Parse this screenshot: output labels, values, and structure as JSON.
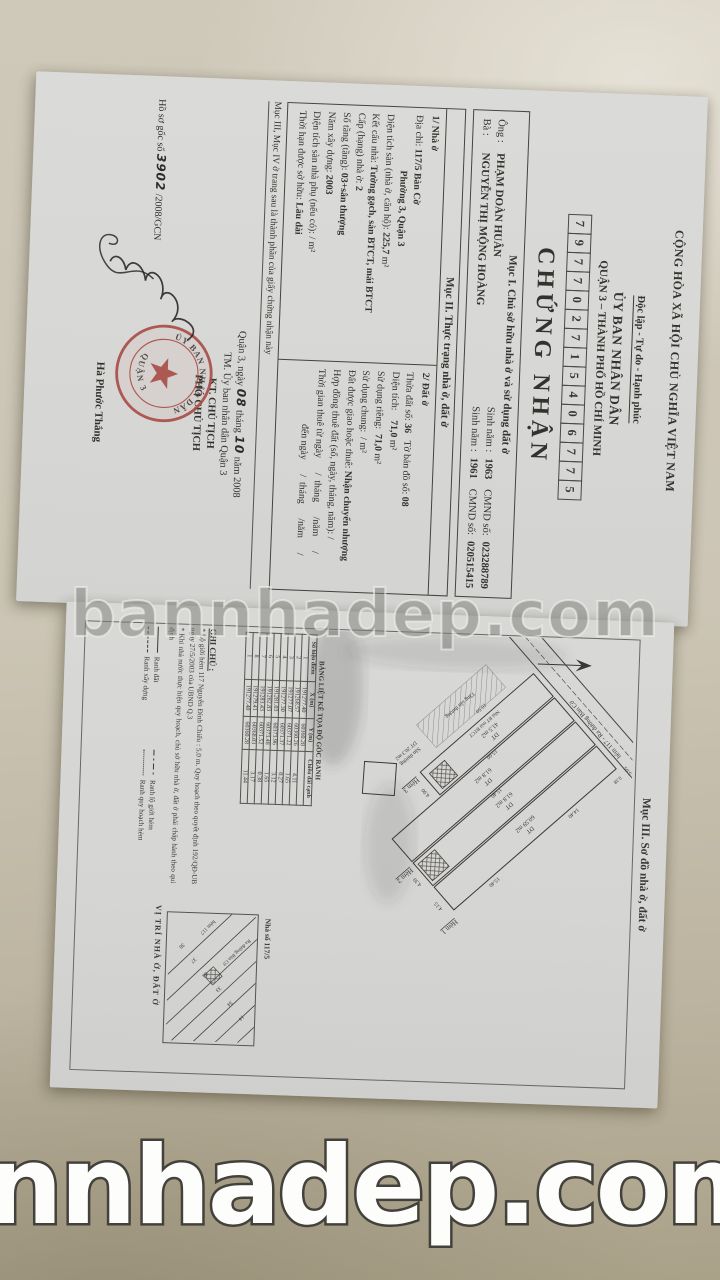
{
  "watermarks": {
    "center": "bannhadep.com",
    "bottom": "nnhadep.com"
  },
  "certificate": {
    "national_motto_1": "CỘNG HÒA XÃ HỘI CHỦ NGHĨA VIỆT NAM",
    "national_motto_2": "Độc lập - Tự do - Hạnh phúc",
    "issuer": "ỦY BAN NHÂN DÂN",
    "issuer_locality": "QUẬN 3 – THÀNH PHỐ HỒ CHÍ MINH",
    "serial_digits": [
      "7",
      "9",
      "7",
      "7",
      "0",
      "2",
      "7",
      "1",
      "5",
      "4",
      "0",
      "6",
      "7",
      "7",
      "5"
    ],
    "title": "CHỨNG NHẬN",
    "section1": {
      "heading": "Mục I. Chủ sở hữu nhà ở và sử dụng đất ở",
      "owner1_label": "Ông :",
      "owner1_name": "PHẠM DOÀN HUÂN",
      "owner1_birth_label": "Sinh năm :",
      "owner1_birth": "1963",
      "owner1_id_label": "CMND số:",
      "owner1_id": "023288789",
      "owner2_label": "Bà :",
      "owner2_name": "NGUYỄN THỊ MỘNG HOÀNG",
      "owner2_birth_label": "Sinh năm :",
      "owner2_birth": "1961",
      "owner2_id_label": "CMND số:",
      "owner2_id": "020515415"
    },
    "section2": {
      "heading": "Mục II. Thực trạng nhà ở, đất ở",
      "house": {
        "heading": "1/ Nhà ở",
        "addr_label": "Địa chỉ:",
        "addr1": "117/5 Bàn Cờ",
        "addr2": "Phường 3, Quận 3",
        "floor_label": "Diện tích sàn (nhà ở, căn hộ):",
        "floor_value": "225,7",
        "floor_unit": "m²",
        "structure_label": "Kết cấu nhà:",
        "structure": "Tường gạch, sàn BTCT, mái BTCT",
        "grade_label": "Cấp (hạng) nhà ở:",
        "grade": "2",
        "storeys_label": "Số tầng (tầng):",
        "storeys": "03+sân thượng",
        "year_label": "Năm xây dựng:",
        "year": "2003",
        "aux_label": "Diện tích sàn nhà phụ (nếu có):",
        "aux_value": "/",
        "aux_unit": "m²",
        "tenure_label": "Thời hạn được sở hữu:",
        "tenure": "Lâu dài"
      },
      "land": {
        "heading": "2/ Đất ở",
        "plot_label": "Thửa đất số:",
        "plot": "36",
        "map_label": "Tờ bản đồ số:",
        "map": "08",
        "area_label": "Diện tích:",
        "area": "71,0",
        "area_unit": "m²",
        "private_label": "Sử dụng riêng:",
        "private_value": "71,0",
        "private_unit": "m²",
        "common_label": "Sử dụng chung:",
        "common_value": "/",
        "common_unit": "m²",
        "grant_label": "Đất được giao hoặc thuê:",
        "grant": "Nhận chuyển nhượng",
        "contract_label": "Hợp đồng thuê đất (số, ngày, tháng, năm):",
        "contract_value": "/",
        "lease_from_line": "Thời gian thuê từ ngày      /  tháng      /năm      /",
        "lease_to_line": "đến ngày      /  tháng      /năm      /"
      }
    },
    "note": "Mục III, Mục IV ở trang sau là thành phần của giấy chứng nhận này",
    "sign": {
      "date_prefix": "Quận 3, ngày",
      "day": "08",
      "month_label": "tháng",
      "month": "10",
      "year_label": "năm",
      "year": "2008",
      "authority": "TM. Ủy ban nhân dân Quận 3",
      "title_kt": "KT. CHỦ TỊCH",
      "title_pho": "PHÓ CHỦ TỊCH",
      "signer": "Hà Phước Thắng",
      "stamp_top": "ỦY BAN NHÂN DÂN",
      "stamp_bottom": "QUẬN 3"
    },
    "file_label": "Hồ sơ gốc số",
    "file_number": "3902",
    "file_suffix": "/2008/GCN"
  },
  "plan": {
    "heading": "Mục III. Sơ đồ nhà ở, đất ở",
    "street_label": "hẻm 117 - Ra đường Bàn Cờ",
    "dt_label": "DT",
    "lots": [
      "60.59 m2",
      "61.8 m2",
      "61.8 m2",
      "41.5 m2"
    ],
    "lot4_note": "Nhà BT mái BTCT",
    "roof_label": "Sân thượng",
    "roof_area": "DT 20.3 m2",
    "terrace_label": "Tầng sân thượng",
    "alley1": "Hẻm 1",
    "alley2": "Hẻm 2",
    "alley3": "Hẻm 3",
    "house_no": "Nhà số 117/5",
    "position_caption": "VỊ TRÍ NHÀ Ở, ĐẤT Ở",
    "dims": {
      "d1": "14.40",
      "d2": "15.40",
      "d3": "15.40",
      "d4": "15.60",
      "d5": "10.50",
      "d6": "4.15",
      "d7": "4.39",
      "d8": "4.90",
      "d9": "5.05",
      "d10": "0.38"
    },
    "coord_table": {
      "title": "BẢNG LIỆT KÊ TỌA ĐỘ GÓC RANH",
      "columns": [
        "Số hiệu điểm",
        "X (m)",
        "Y (m)",
        "Chiều dài cạnh"
      ],
      "rows": [
        [
          "1",
          "191277.40",
          "60360.28",
          ""
        ],
        [
          "2",
          "191268.57",
          "60360.26",
          "4.11"
        ],
        [
          "3",
          "191277.07",
          "60371.22",
          "1.65"
        ],
        [
          "4",
          "191277.30",
          "60371.37",
          "0.27"
        ],
        [
          "5",
          "191281.03",
          "60373.96",
          "3.12"
        ],
        [
          "6",
          "191282.83",
          "60373.48",
          "1.65"
        ],
        [
          "7",
          "191283.43",
          "60371.52",
          "0.38"
        ],
        [
          "8",
          "191279.41",
          "60368.03",
          "3.17"
        ],
        [
          "1",
          "191277.40",
          "60360.28",
          "11.44"
        ]
      ]
    },
    "notes": {
      "heading": "GHI CHÚ :",
      "line1": "* Lộ giới hẻm 117 Nguyễn Đình Chiểu : 5.0 m. Quy hoạch theo quyết định 192/QĐ-UB ngày 27/5/2003 của UBND Q.3",
      "line2": "* Khi nhà nước thực hiện quy hoạch, chủ sở hữu nhà ở, đất ở phải chấp hành theo qui định",
      "legend1": "Ranh đất",
      "legend2": "Ranh xây dựng",
      "legend3": "Ranh lộ giới hẻm",
      "legend4": "Ranh quy hoạch hẻm"
    },
    "inset": {
      "street": "hẻm 117",
      "street2": "Ra đường Bàn Cờ",
      "lot_a": "14",
      "lot_b": "34",
      "lot_c": "33",
      "lot_d": "36",
      "lot_e": "37",
      "lot_f": "38"
    }
  }
}
